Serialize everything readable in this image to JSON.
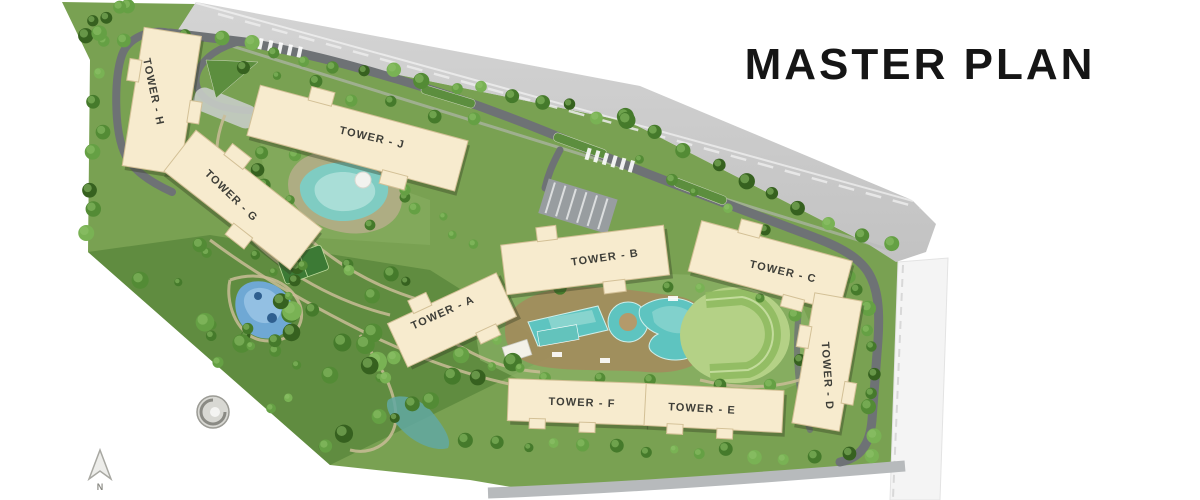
{
  "title": "MASTER PLAN",
  "compass": {
    "label": "N"
  },
  "map": {
    "towers": [
      {
        "id": "tower-h",
        "label": "TOWER - H"
      },
      {
        "id": "tower-g",
        "label": "TOWER - G"
      },
      {
        "id": "tower-j",
        "label": "TOWER - J"
      },
      {
        "id": "tower-a",
        "label": "TOWER - A"
      },
      {
        "id": "tower-b",
        "label": "TOWER - B"
      },
      {
        "id": "tower-c",
        "label": "TOWER - C"
      },
      {
        "id": "tower-d",
        "label": "TOWER - D"
      },
      {
        "id": "tower-e",
        "label": "TOWER - E"
      },
      {
        "id": "tower-f",
        "label": "TOWER - F"
      }
    ]
  },
  "colors": {
    "background": "#ffffff",
    "title_text": "#151515",
    "building": "#f7ebce",
    "label_text": "#3e3e38",
    "highway": "#c9c9c9",
    "internal_road": "#6e7275",
    "greenery": "#79a152",
    "pool_water": "#5ec4c0",
    "pond_water": "#6fa8d4"
  }
}
